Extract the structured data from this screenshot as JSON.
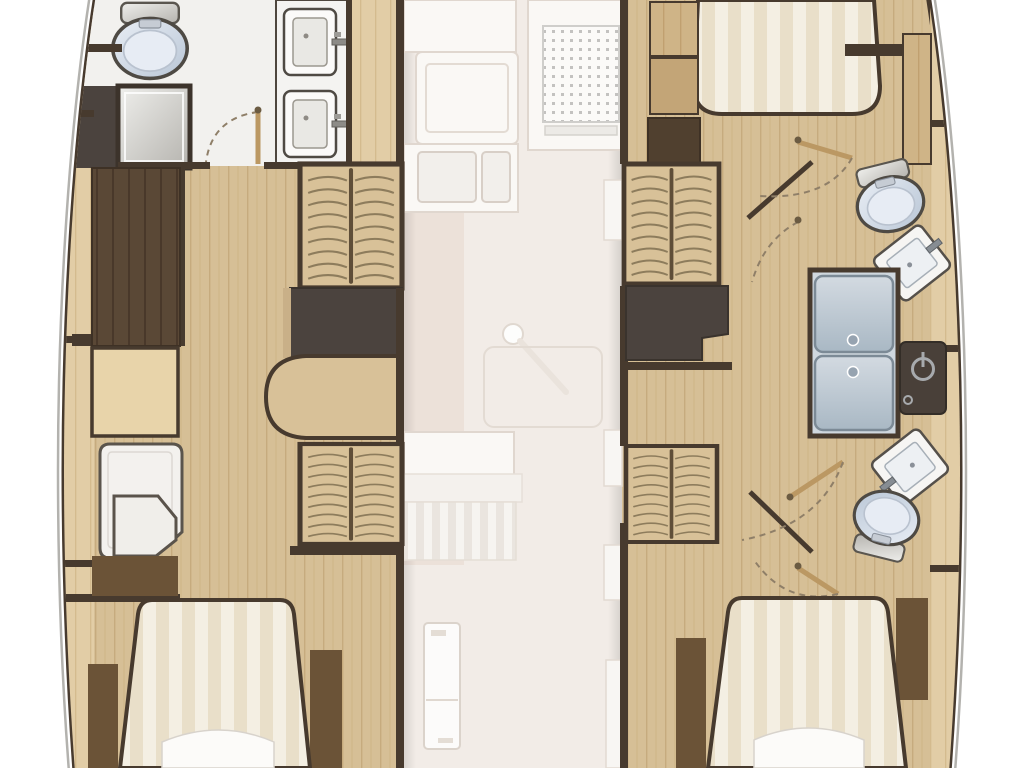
{
  "document": {
    "kind": "yacht-deck-floor-plan",
    "view": "top-down",
    "hulls": 2,
    "visible_text": ""
  },
  "palette": {
    "background": "#ffffff",
    "outline_grey": "#b3b2ae",
    "walls": "#473a2e",
    "hull_wood": "#d6bf96",
    "deck_plank_pale": "#e2cda6",
    "plank_mid": "#cfb487",
    "charcoal": "#4b433e",
    "wardrobe": "#5a4836",
    "cabinet_brown": "#6b5337",
    "salon_floor": "#f2ece7",
    "salon_floor_dim": "#eadfd6",
    "fixture_white": "#f5f4f1",
    "porcelain_light": "#e9eef5",
    "porcelain_dark": "#b9c6d6",
    "shower_silver_light": "#efefec",
    "shower_silver_dark": "#b5b3ae",
    "shower_glass_light": "#d3dae1",
    "shower_glass_dark": "#a9b8c4",
    "mattress_cream": "#f4efe3",
    "mattress_stripe": "#e9dfc9",
    "stairs_wood": "#d8c198",
    "control_panel": "#494039",
    "control_icon": "#a7aaad"
  },
  "areas": {
    "port_hull": {
      "fixtures": [
        "toilet",
        "shower-stall",
        "vanity-twin-sinks",
        "wardrobe",
        "staircase-forward",
        "landing",
        "rounded-step",
        "desk",
        "chaise-berth",
        "staircase-aft",
        "seat",
        "double-bed-aft",
        "nightstands"
      ]
    },
    "salon_deck": {
      "fixtures": [
        "galley-counter",
        "galley-sink",
        "stove",
        "serving-knob",
        "dining-table",
        "sofa",
        "shelf",
        "refrigerator"
      ]
    },
    "starboard_hull": {
      "fixtures": [
        "double-bed-forward",
        "wardrobe",
        "staircase-forward",
        "landing",
        "toilet-forward",
        "sink-forward",
        "shower-cabin",
        "shower-control-panel",
        "sink-aft",
        "toilet-aft",
        "staircase-aft",
        "double-bed-aft",
        "nightstands",
        "door-swings"
      ]
    }
  }
}
